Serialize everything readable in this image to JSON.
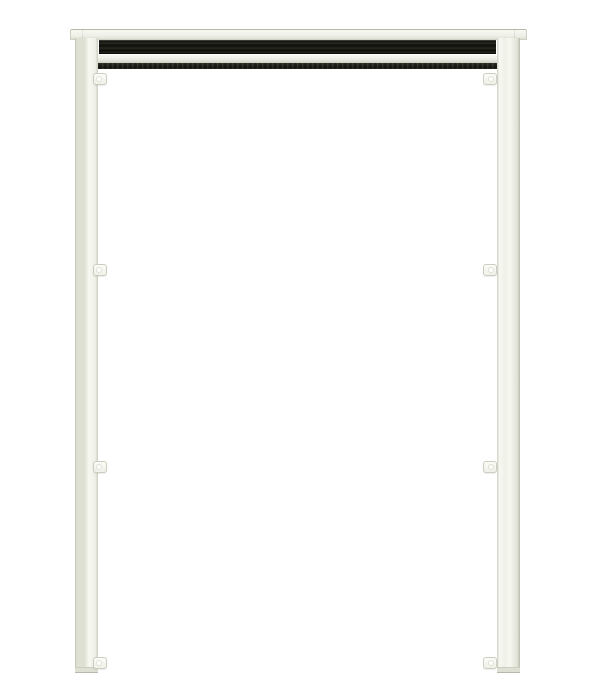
{
  "image": {
    "width": 600,
    "height": 700,
    "background": "#ffffff",
    "content": "product-photo-retractable-screen-frame"
  },
  "colors": {
    "bg": "#ffffff",
    "frame-light": "#f7f8f1",
    "frame-base": "#eff0e8",
    "frame-shade": "#dfe0d4",
    "frame-mid": "#cdcec1",
    "frame-edge": "#b8b9ac",
    "band-black": "#1c1d17",
    "brush-dark": "#22241c"
  },
  "scene": {
    "parts": {
      "header-cap": {
        "x": 70,
        "y": 29,
        "w": 457,
        "h": 11
      },
      "cap-seam-left": {
        "x": 82,
        "y": 29,
        "w": 1,
        "h": 11
      },
      "cap-seam-right": {
        "x": 514,
        "y": 29,
        "w": 1,
        "h": 11
      },
      "roller-band": {
        "x": 99,
        "y": 40,
        "w": 397,
        "h": 14
      },
      "housing-bar": {
        "x": 85,
        "y": 54,
        "w": 430,
        "h": 9
      },
      "brush-seal": {
        "x": 87,
        "y": 63,
        "w": 426,
        "h": 6
      },
      "rail-left": {
        "x": 75,
        "y": 38,
        "w": 23,
        "h": 635
      },
      "rail-right": {
        "x": 497,
        "y": 38,
        "w": 23,
        "h": 635
      }
    },
    "clips": {
      "w": 14,
      "h": 12,
      "left_x": 93,
      "right_x": 483,
      "ys": [
        73,
        264,
        461,
        657
      ]
    }
  }
}
